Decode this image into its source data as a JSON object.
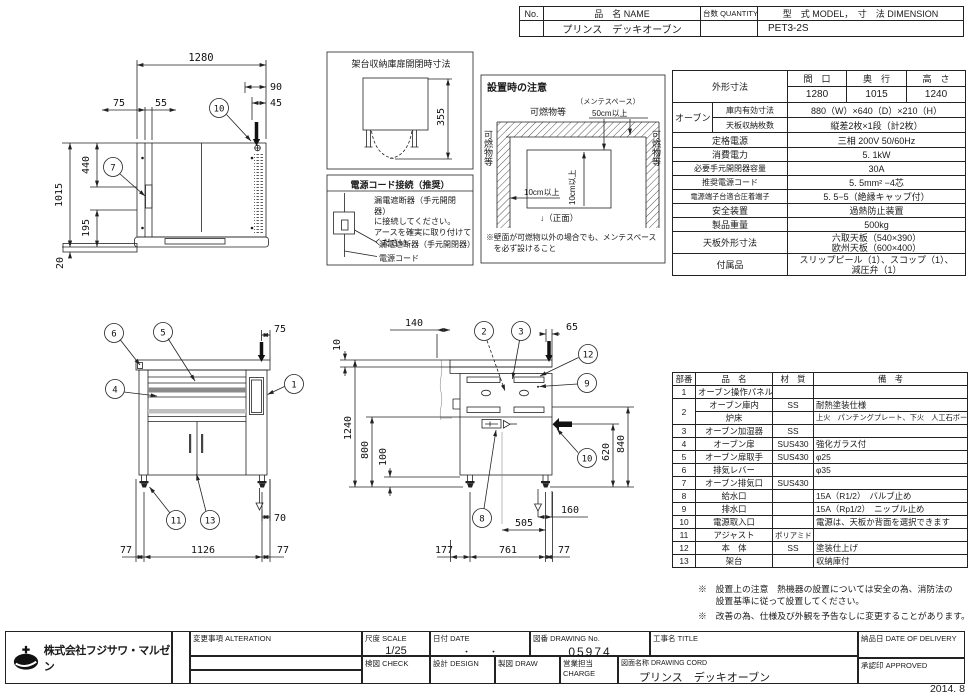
{
  "header_table": {
    "no": "No.",
    "name_label": "品　名 NAME",
    "qty_label": "台数 QUANTITY",
    "model_label": "型　式 MODEL",
    "dim_label": "，　寸　法 DIMENSION",
    "name_value": "プリンス　デッキオーブン",
    "model_value": "PET3-2S"
  },
  "spec_table": {
    "size_label": "外形寸法",
    "size_cols": [
      "間　口",
      "奥　行",
      "高　さ"
    ],
    "size_vals": [
      "1280",
      "1015",
      "1240"
    ],
    "oven_label": "オーブン",
    "oven_rows": [
      {
        "label": "庫内有効寸法",
        "value": "880（W）×640（D）×210（H）"
      },
      {
        "label": "天板収納枚数",
        "value": "縦差2枚×1段（計2枚）"
      }
    ],
    "rows": [
      {
        "label": "定格電源",
        "value": "三相  200V  50/60Hz"
      },
      {
        "label": "消費電力",
        "value": "5. 1kW"
      },
      {
        "label": "必要手元開閉器容量",
        "value": "30A"
      },
      {
        "label": "推奨電源コード",
        "value": "5. 5mm² −4芯"
      },
      {
        "label": "電源端子台適合圧着端子",
        "value": "5. 5−5（絶縁キャップ付）"
      },
      {
        "label": "安全装置",
        "value": "過熱防止装置"
      },
      {
        "label": "製品重量",
        "value": "500kg"
      },
      {
        "label": "天板外形寸法",
        "value": "六取天板（540×390）\n欧州天板（600×400）"
      },
      {
        "label": "付属品",
        "value": "スリップピール（1）、スコップ（1）、\n減圧弁（1）"
      }
    ]
  },
  "parts_table": {
    "headers": [
      "部番",
      "品　名",
      "材　質",
      "備　考"
    ],
    "rows": [
      {
        "no": "1",
        "name": "オーブン操作パネル",
        "mat": "",
        "note": ""
      },
      {
        "no": "2",
        "name": "オーブン庫内",
        "mat": "SS",
        "note": "耐熱塗装仕様"
      },
      {
        "no": "",
        "name": "炉床",
        "mat": "",
        "note": "上火　パンチングプレート、下火　人工石ボード"
      },
      {
        "no": "3",
        "name": "オーブン加湿器",
        "mat": "SS",
        "note": ""
      },
      {
        "no": "4",
        "name": "オーブン扉",
        "mat": "SUS430",
        "note": "強化ガラス付"
      },
      {
        "no": "5",
        "name": "オーブン扉取手",
        "mat": "SUS430",
        "note": "φ25"
      },
      {
        "no": "6",
        "name": "排気レバー",
        "mat": "",
        "note": "φ35"
      },
      {
        "no": "7",
        "name": "オーブン排気口",
        "mat": "SUS430",
        "note": ""
      },
      {
        "no": "8",
        "name": "給水口",
        "mat": "",
        "note": "15A（R1/2）　バルブ止め"
      },
      {
        "no": "9",
        "name": "排水口",
        "mat": "",
        "note": "15A（Rp1/2）　ニップル止め"
      },
      {
        "no": "10",
        "name": "電源取入口",
        "mat": "",
        "note": "電源は、天板か背面を選択できます"
      },
      {
        "no": "11",
        "name": "アジャスト",
        "mat": "ポリアミド",
        "note": ""
      },
      {
        "no": "12",
        "name": "本　体",
        "mat": "SS",
        "note": "塗装仕上げ"
      },
      {
        "no": "13",
        "name": "架台",
        "mat": "",
        "note": "収納庫付"
      }
    ]
  },
  "notes": {
    "note1": "※　設置上の注意　熱機器の設置については安全の為、消防法の\n　　設置基準に従って設置してください。",
    "note2": "※　改善の為、仕様及び外観を予告なしに変更することがあります。"
  },
  "title_block": {
    "company": "株式会社フジサワ・マルゼン",
    "alteration_label": "変更事項 ALTERATION",
    "scale_label": "尺度  SCALE",
    "scale_value": "1/25",
    "date_label": "日付  DATE",
    "date_value": "・　　・",
    "dwgno_label": "図番  DRAWING No.",
    "dwgno_value": "05974",
    "title_label": "工事名  TITLE",
    "check_label": "検図  CHECK",
    "design_label": "設計  DESIGN",
    "draw_label": "製図  DRAW",
    "charge_label": "営業担当 CHARGE",
    "dwgname_label": "図面名称  DRAWING CORD",
    "dwgname_value": "プリンス　デッキオーブン",
    "delivery_label": "納品日  DATE OF DELIVERY",
    "approved_label": "承認印  APPROVED",
    "issue": "2014. 8"
  },
  "drawings": {
    "top_view": {
      "balloon_10": "10",
      "balloon_7": "7",
      "dims": {
        "w": "1280",
        "d90": "90",
        "d45": "45",
        "d75": "75",
        "d55": "55",
        "d440": "440",
        "d1015": "1015",
        "d195": "195",
        "d20": "20"
      }
    },
    "front_view": {
      "balloon_6": "6",
      "balloon_5": "5",
      "balloon_4": "4",
      "balloon_1": "1",
      "balloon_11": "11",
      "balloon_13": "13",
      "dims": {
        "t75": "75",
        "r70": "70",
        "b77l": "77",
        "b1126": "1126",
        "b77r": "77"
      }
    },
    "side_view": {
      "balloon_2": "2",
      "balloon_3": "3",
      "balloon_12": "12",
      "balloon_9": "9",
      "balloon_10": "10",
      "balloon_8": "8",
      "dims": {
        "t140": "140",
        "t10": "10",
        "t65": "65",
        "h1240": "1240",
        "h800": "800",
        "h100": "100",
        "h620": "620",
        "h840": "840",
        "b160": "160",
        "b505": "505",
        "b177": "177",
        "b761": "761",
        "b77": "77"
      }
    },
    "rack_box": {
      "title": "架台収納庫扉開閉時寸法",
      "dim355": "355"
    },
    "power_box": {
      "title": "電源コード接続（推奨）",
      "text": "漏電遮断器（手元開閉器）\nに接続してください。\nアースを確実に取り付けて\nください。",
      "label1": "漏電遮断器（手元開閉器）",
      "label2": "電源コード"
    },
    "install_box": {
      "title": "設置時の注意",
      "top_label": "可燃物等",
      "left_label": "可燃物等",
      "right_label": "可燃物等",
      "maint": "（メンテスペース）",
      "dim50": "50cm以上",
      "dim10h": "10cm以上",
      "dim10v": "10cm以上",
      "front": "↓（正面）",
      "note": "※壁面が可燃物以外の場合でも、メンテスペース\n　を必ず設けること"
    }
  }
}
